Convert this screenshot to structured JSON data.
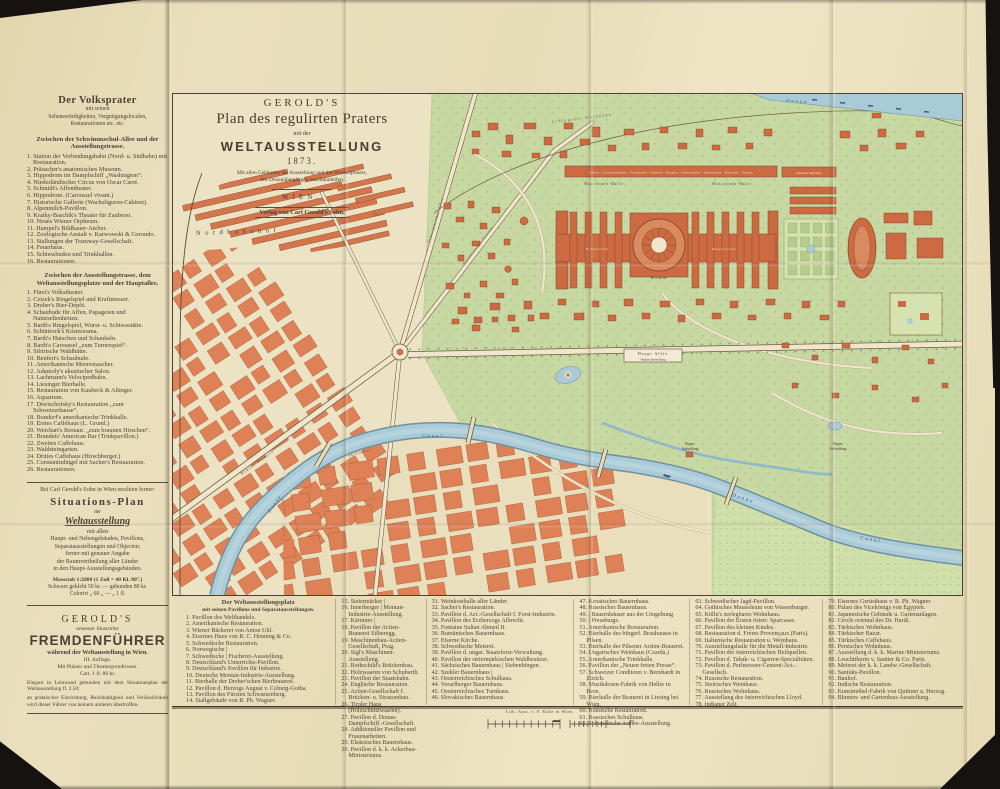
{
  "colors": {
    "paper": "#e8ddb9",
    "map_paper": "#ece3c4",
    "building": "#cc6a42",
    "city_block": "#df8157",
    "park": "#c8d8a2",
    "water": "#a9cbd8",
    "ink": "#4a4036"
  },
  "title_block": {
    "publisher": "GEROLD'S",
    "title": "Plan des regulirten Praters",
    "connector": "mit der",
    "main": "WELTAUSSTELLUNG",
    "year": "1873.",
    "caption1": "Mit allen Gebäuden der Ausstellung und des Wurstelpraters,",
    "caption2": "den Donauübergängen und Bahnhöfen.",
    "city": "WIEN.",
    "imprint": "Verlag von Carl Gerold's Sohn."
  },
  "sidebar": {
    "volksprater": {
      "title": "Der Volksprater",
      "sub1": "mit seinen",
      "sub2": "Sehenswürdigkeiten, Vergnügungslocalen,",
      "sub3": "Restaurationen etc. etc.",
      "section1_title": "Zwischen der Schwimmschul-Allee und der Ausstellungstrasse.",
      "section1_items": [
        "1. Station der Verbindungsbahn (Nord- u. Südbahn) mit Restauration.",
        "2. Präuscher's anatomisches Museum.",
        "3. Hippodrom im Dampfschiff „Washington“.",
        "4. Niederländischer Circus von Oscar Carré.",
        "5. Schmidt's Affentheater.",
        "6. Hippodrom. (Caroussel vivant.)",
        "7. Historische Gallerie (Wachsfiguren-Cabinet).",
        "8. Alpenmilch-Pavillon.",
        "9. Kratky-Baschik's Theater für Zauberei.",
        "10. Neues Wiener Orpheum.",
        "11. Hampel's Bildhauer-Atelier.",
        "12. Zoologische Anstalt v. Karwowski & Gerondo.",
        "13. Stallungen der Tramway-Gesellschaft.",
        "14. Feuerhaus.",
        "15. Schiessbuden und Trinkhallen.",
        "16. Restaurationen."
      ],
      "section2_title": "Zwischen der Ausstellungstrasse, dem Weltausstellungsplatze und der Hauptallee.",
      "section2_items": [
        "1. Fürst's Volkstheater.",
        "2. Czizek's Ringelspiel und Kraftmesser.",
        "3. Dreher's Bier-Depôt.",
        "4. Schaubude für Affen, Papageien und Naturseltenheiten.",
        "5. Barth's Ringelspiel, Wurst- u. Schiessstätte.",
        "6. Schüttrock's Kosmorama.",
        "7. Barth's Hutschen und Schaukeln.",
        "8. Barth's Caroussel „zum Turnerspiel“.",
        "9. Sibirische Waldhütte.",
        "10. Benfert's Schaubude.",
        "11. Amerikanische Meerestaucher.",
        "12. Adamoly's akustischer Salon.",
        "13. Lachmann's Velocipedbahn.",
        "14. Liesinger Bierhalle.",
        "15. Restauration von Kaubeck & Altinger.",
        "16. Aquarium.",
        "17. Diwischofsky's Restauration „zum Schweizerhause“.",
        "18. Bondorf's amerikanische Trinkhalle.",
        "19. Erstes Caffehaus (L. Grund.)",
        "20. Weichart's Restaur. „zum braunen Hirschen“.",
        "21. Brandeis' American Bar (Trinkpavillon.)",
        "22. Zweites Caffehaus.",
        "23. Waldsteingarten.",
        "24. Drittes Caffehaus (Hirschberger.)",
        "25. Constantinhügel mit Sacher's Restauration.",
        "26. Restaurationen."
      ]
    },
    "ad_plan": {
      "intro": "Bei Carl Gerold's Sohn in Wien erschien ferner:",
      "title": "Situations-Plan",
      "der": "der",
      "subject": "Weltausstellung",
      "lines": [
        "mit allen",
        "Haupt- und Nebengebäuden, Pavillons,",
        "Separatausstellungen und Objecten;",
        "ferner mit genauer Angabe",
        "der Raumvertheilung aller Länder",
        "in den Haupt-Ausstellungsgebäuden."
      ],
      "scale": "Massstab 1:2880 (1 Zoll = 40 Kl. 80°.)",
      "price1": "Schwarz geklebt 50 kr. — gebunden 80 kr.",
      "price2": "Colorirt  „  60 „  —  „  1 fl."
    },
    "ad_guide": {
      "publisher": "GEROLD'S",
      "sub": "neuester illustrirter",
      "title": "FREMDENFÜHRER",
      "sub2": "während der Weltausstellung in Wien.",
      "edition": "III. Auflage.",
      "sub3": "Mit Plänen und Theatergrundrissen.",
      "price": "Cart. 1 fl. 80 kr.",
      "para1": "Elegant in Leinwand gebunden mit dem Situationsplan der Weltausstellung fl. 2.50;",
      "para2": "an praktischer Einrichtung, Reichhaltigkeit und Verlässlichkeit wird dieser Führer von keinem anderen übertroffen."
    }
  },
  "map_labels": {
    "nordbahnhof": "Nordbahnhof",
    "schlag_der_nordbahn": "Schlag der Nordbahn",
    "donau": "Donau",
    "canal": "Canal",
    "am_schuettel": "Am Schüttel",
    "prater_strasse": "Prater-Strasse",
    "schwimmschul_allee": "Schwimmschul-Allee",
    "ausstellungs_strasse": "Ausstellungs-Strasse",
    "maschinen_halle": "Maschinen-Halle",
    "countries_band": "Italien · Grossbritannien · Frankreich · Schweiz · Belgien · Deutschland · Oesterreich · Russland · Ungarn",
    "deutsche_agricultur": "Deutsche Agricultur",
    "rotunde": "Rotunde",
    "frankreich": "Frankreich",
    "oesterreich": "Oesterreich",
    "haupt_allee": "Haupt Allee",
    "wagen_aufstellung": "Wagen Aufstellung",
    "wagen": "Wagen-",
    "aufstellung": "Aufstellung"
  },
  "legend": {
    "header1": "Der Weltausstellungsplatz",
    "header2": "mit seinen Pavillons und Separatausstellungen.",
    "cols": {
      "c1": [
        "1. Pavillon des Welthandels.",
        "2. Amerikanische Restauration.",
        "3. Wiener Bäckerei von Anton Uhl.",
        "4. Eisernes Haus von R. C. Henning & Co.",
        "5. Schwedische Restauration.",
        "6. Norwegische |",
        "7. Schwedische | Fischerei-Ausstellung.",
        "8. Deutschland's Unterrichts-Pavillon.",
        "9. Deutschland's Pavillon für Industrie.",
        "10. Deutsche Montan-Industrie-Ausstellung.",
        "11. Bierhalle der Dreher'schen Bierbrauerei.",
        "12. Pavillon d. Herzogs August v. Coburg-Gotha.",
        "13. Pavillon des Fürsten Schwarzenberg.",
        "14. Stallgebäude von R. Ph. Wagner."
      ],
      "c2": [
        "15. Steiermärker |",
        "16. Innerberger | Montan-Industrie-Ausstellung.",
        "17. Kärntner |",
        "18. Pavillon der Actien-Brauerei Silberegg.",
        "19. Maschinenbau-Actien-Gesellschaft, Prag.",
        "20. Sigl's Maschinen-Ausstellung.",
        "21. Rothschild's Brückenbau.",
        "22. Holzwaaren von Schuberth.",
        "23. Pavillon der Staatsbahn.",
        "24. Englische Restauration.",
        "25. Actien-Gesellschaft f. Brücken- u. Strassenbau.",
        "26. Tiroler Haus (Holzschnitzwaaren).",
        "27. Pavillon d. Donau-Dampfschiff.-Gesellschaft.",
        "28. Additioneller Pavillon und Frauenarbeiten.",
        "29. Elsässisches Bauernhaus.",
        "30. Pavillon d. k. k. Ackerbau-Ministeriums."
      ],
      "c3": [
        "31. Weinkosthalle aller Länder.",
        "32. Sacher's Restauration.",
        "33. Pavillon d. Act.-Gesellschaft f. Forst-Industrie.",
        "34. Pavillon des Erzherzogs Albrecht.",
        "35. Fontaine Sultan Ahmed II.",
        "36. Rumänisches Bauernhaus.",
        "37. Eiserne Kirche.",
        "38. Schwedische Meierei.",
        "39. Pavillon d. ungar. Staatsforst-Verwaltung.",
        "40. Pavillon der steiermärkischen Waldbesitzer.",
        "41. Sächsisches Bauernhaus | Siebenbürgen.",
        "42. Szekler Bauernhaus |",
        "43. Oesterreichisches Schulhaus.",
        "44. Vorarlberger Bauernhaus.",
        "45. Oesterreichisches Turnhaus.",
        "46. Slovakisches Bauernhaus."
      ],
      "c4": [
        "47. Kroatisches Bauernhaus.",
        "48. Russisches Bauernhaus.",
        "49. | Bauernhäuser aus der Umgebung",
        "50. | Pressburgs.",
        "51. Amerikanische Restauration.",
        "52. Bierhalle des bürgerl. Brauhauses in Pilsen.",
        "53. Bierhalle der Pilsener Actien-Brauerei.",
        "54. Ungarisches Weinhaus (Czarda.)",
        "55. Amerikanische Trinkhalle.",
        "56. Pavillon der „Neuen freien Presse“.",
        "57. Schweizer Conditorei v. Bernhardt in Zürich.",
        "58. Musikdosen-Fabrik von Heller in Bern.",
        "59. Bierhalle der Brauerei in Liesing bei Wien.",
        "60. Russische Restauration.",
        "61. Russisches Schulhaus.",
        "62. Schwedische Armee-Ausstellung."
      ],
      "c5": [
        "63. Schwedischer Jagd-Pavillon.",
        "64. Gothisches Mausoleum von Wasserburger.",
        "65. Kölln's zerlegbares Wohnhaus.",
        "66. Pavillon der Ersten österr. Sparcasse.",
        "67. Pavillon des kleinen Kindes.",
        "68. Restauration d. Frères Provençaux (Paris).",
        "69. Italienische Restauration u. Weinhaus.",
        "70. Ausstellungshalle für die Metall-Industrie.",
        "71. Pavillon der österreichischen Heilquellen.",
        "72. Pavillon d. Tabak- u. Cigarren-Specialitäten.",
        "73. Pavillon d. Perlmooser-Cement-Act.-Gesellsch.",
        "74. Russische Restauration.",
        "75. Steirisches Weinhaus.",
        "76. Russisches Wohnhaus.",
        "77. Ausstellung des österreichischen Lloyd.",
        "78. Indianer Zelt."
      ],
      "c6": [
        "79. Eisernes Gerüsthaus v. R. Ph. Wagner.",
        "80. Palast des Vicekönigs von Egypten.",
        "81. Japanesische Gebäude u. Gartenanlagen.",
        "82. Cercle oriental des Dr. Hardi.",
        "83. Türkisches Wohnhaus.",
        "84. Türkischer Bazar.",
        "85. Türkisches Caffehaus.",
        "86. Persisches Wohnhaus.",
        "87. Ausstellung d. k. k. Marine-Ministeriums.",
        "88. Leuchtthurm v. Sautter & Co. Paris.",
        "89. Meierei der k. k. Landw.-Gesellschaft.",
        "90. Sanitäts-Pavillon.",
        "91. Bauhof.",
        "92. Indische Restauration.",
        "93. Kunstmöbel-Fabrik von Quittner u. Herzog.",
        "94. Blumen- und Gartenbau-Ausstellung."
      ]
    }
  },
  "imprint": "Lith. Anst. v. F. Köke in Wien."
}
